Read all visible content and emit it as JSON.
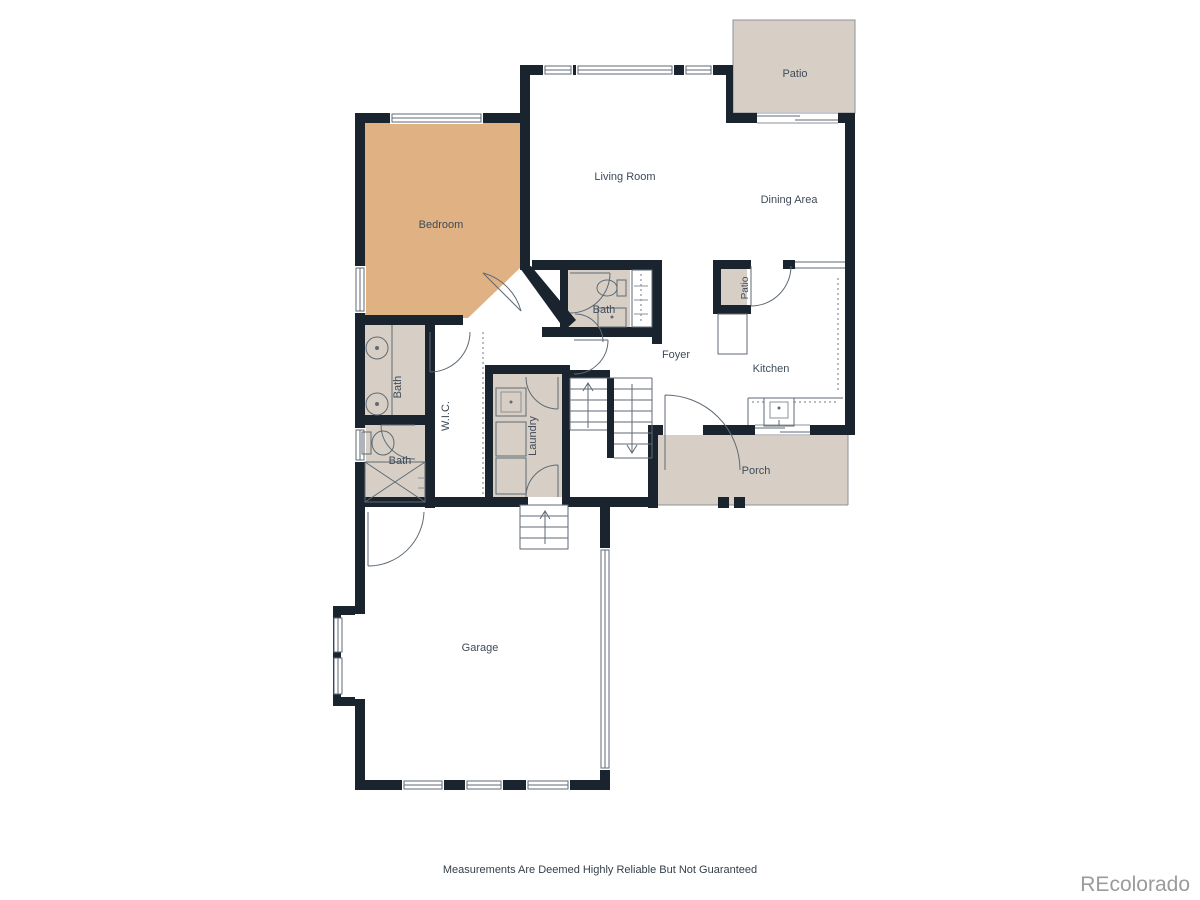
{
  "floorplan": {
    "rooms": {
      "patio": "Patio",
      "living_room": "Living Room",
      "dining_area": "Dining Area",
      "bedroom": "Bedroom",
      "bath_upper": "Bath",
      "pantry_nook": "Patio",
      "foyer": "Foyer",
      "kitchen": "Kitchen",
      "bath_primary": "Bath",
      "wic": "W.I.C.",
      "laundry": "Laundry",
      "bath_lower": "Bath",
      "porch": "Porch",
      "garage": "Garage"
    },
    "footer": {
      "disclaimer": "Measurements Are Deemed Highly Reliable But Not Guaranteed",
      "watermark": "REcolorado"
    },
    "colors": {
      "wall": "#1a242e",
      "bedroom_fill": "#dfb183",
      "beige_fill": "#d7cfc5",
      "line": "#5f6a74",
      "text": "#3e4b59",
      "watermark": "#9b9b99",
      "background": "#ffffff"
    }
  }
}
